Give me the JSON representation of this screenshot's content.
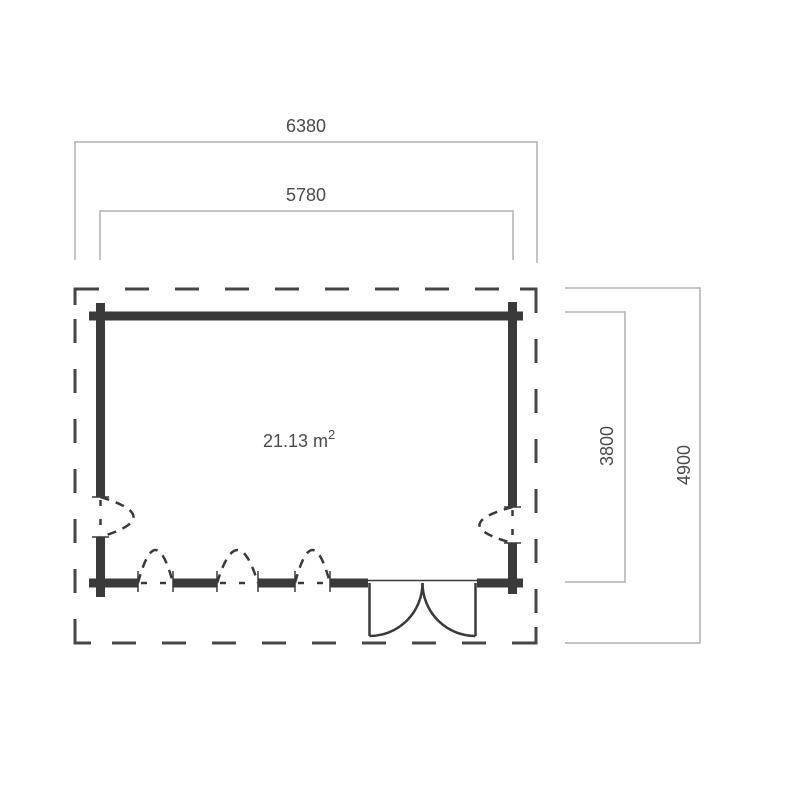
{
  "area": {
    "value": "21.13 m",
    "exponent": "2"
  },
  "dimensions": {
    "outer_width": "6380",
    "inner_width": "5780",
    "inner_depth": "3800",
    "outer_depth": "4900"
  },
  "colors": {
    "wall": "#3a3a3a",
    "outline": "#464646",
    "dimension_line": "#b1b1b1",
    "text": "#4a4a4a",
    "background": "#ffffff"
  }
}
